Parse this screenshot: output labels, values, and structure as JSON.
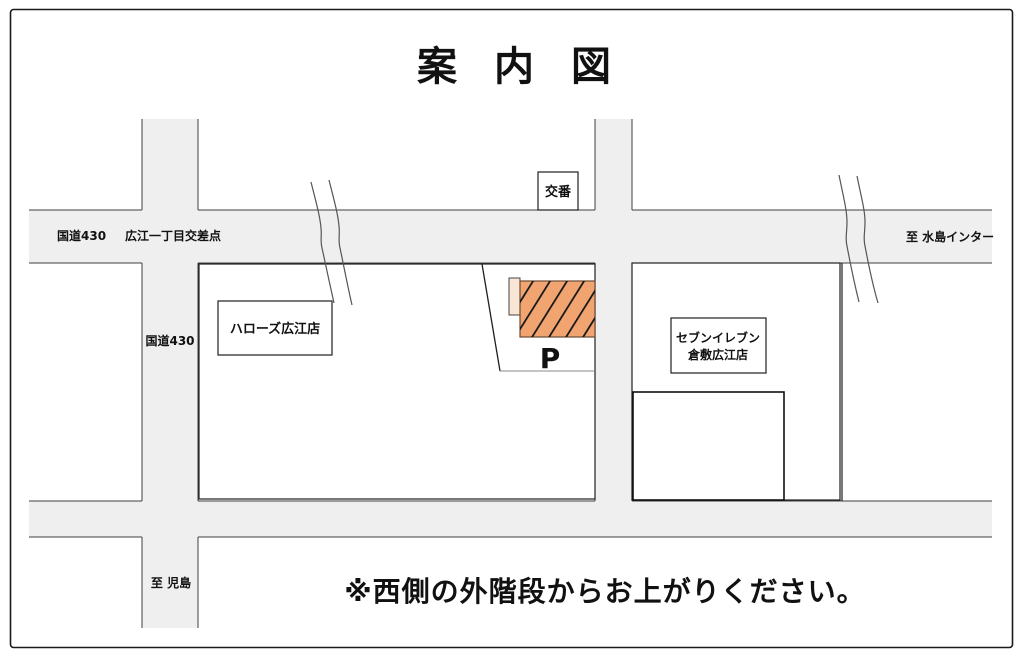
{
  "title": "案内図",
  "map": {
    "roads": {
      "route430_top_label": "国道430",
      "intersection_label": "広江一丁目交差点",
      "to_mizushima_label": "至 水島インター",
      "route430_left_label": "国道430",
      "to_kojima_label": "至 児島"
    },
    "landmarks": {
      "koban": "交番",
      "hallows": "ハローズ広江店",
      "seven_eleven_line1": "セブンイレブン",
      "seven_eleven_line2": "倉敷広江店",
      "parking": "P"
    },
    "note": "※西側の外階段からお上がりください。",
    "colors": {
      "road_fill": "#efefef",
      "building_fill": "#f2a470",
      "building_annex_fill": "#f9e5d5",
      "line": "#1f1f1f",
      "ink": "#111111"
    }
  }
}
